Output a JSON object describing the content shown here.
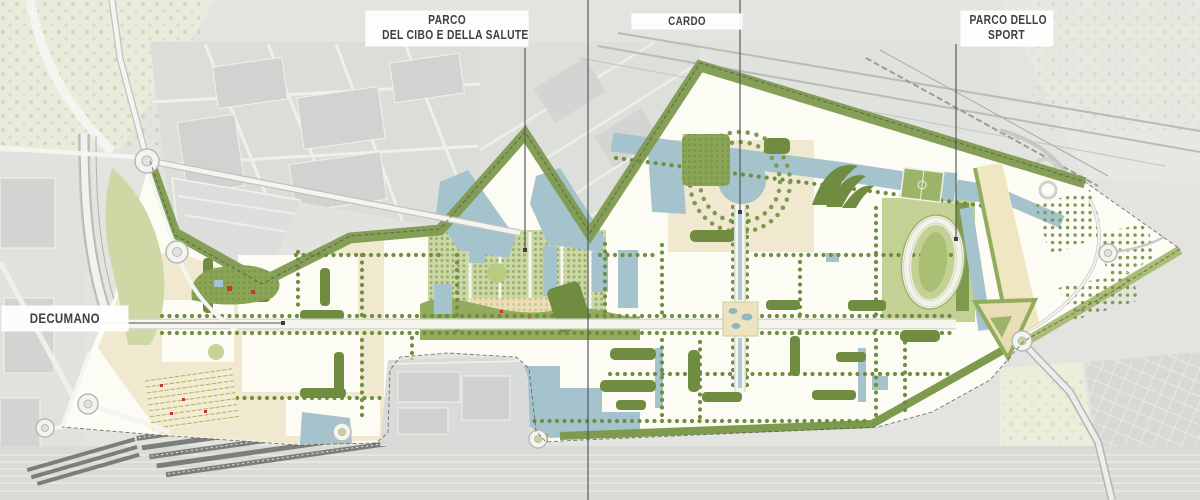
{
  "map": {
    "kind": "urban-masterplan-site-plan",
    "labels": {
      "parco_cibo_line1": "PARCO",
      "parco_cibo_line2": "DEL CIBO E DELLA SALUTE",
      "cardo": "CARDO",
      "parco_sport_line1": "PARCO DELLO",
      "parco_sport_line2": "SPORT",
      "decumano": "DECUMANO"
    },
    "colors": {
      "context_bg": "#e3e4e0",
      "site_bg": "#fcfbf4",
      "beige_plots": "#f0e9cf",
      "water": "#a5c3cc",
      "tree_green": "#7e9a4e",
      "hedge_green": "#6f8c41",
      "lawn_green": "#c6d595",
      "label_text": "#3c4144",
      "leader_line": "#4b4f52",
      "accent_red": "#c8372f"
    }
  }
}
